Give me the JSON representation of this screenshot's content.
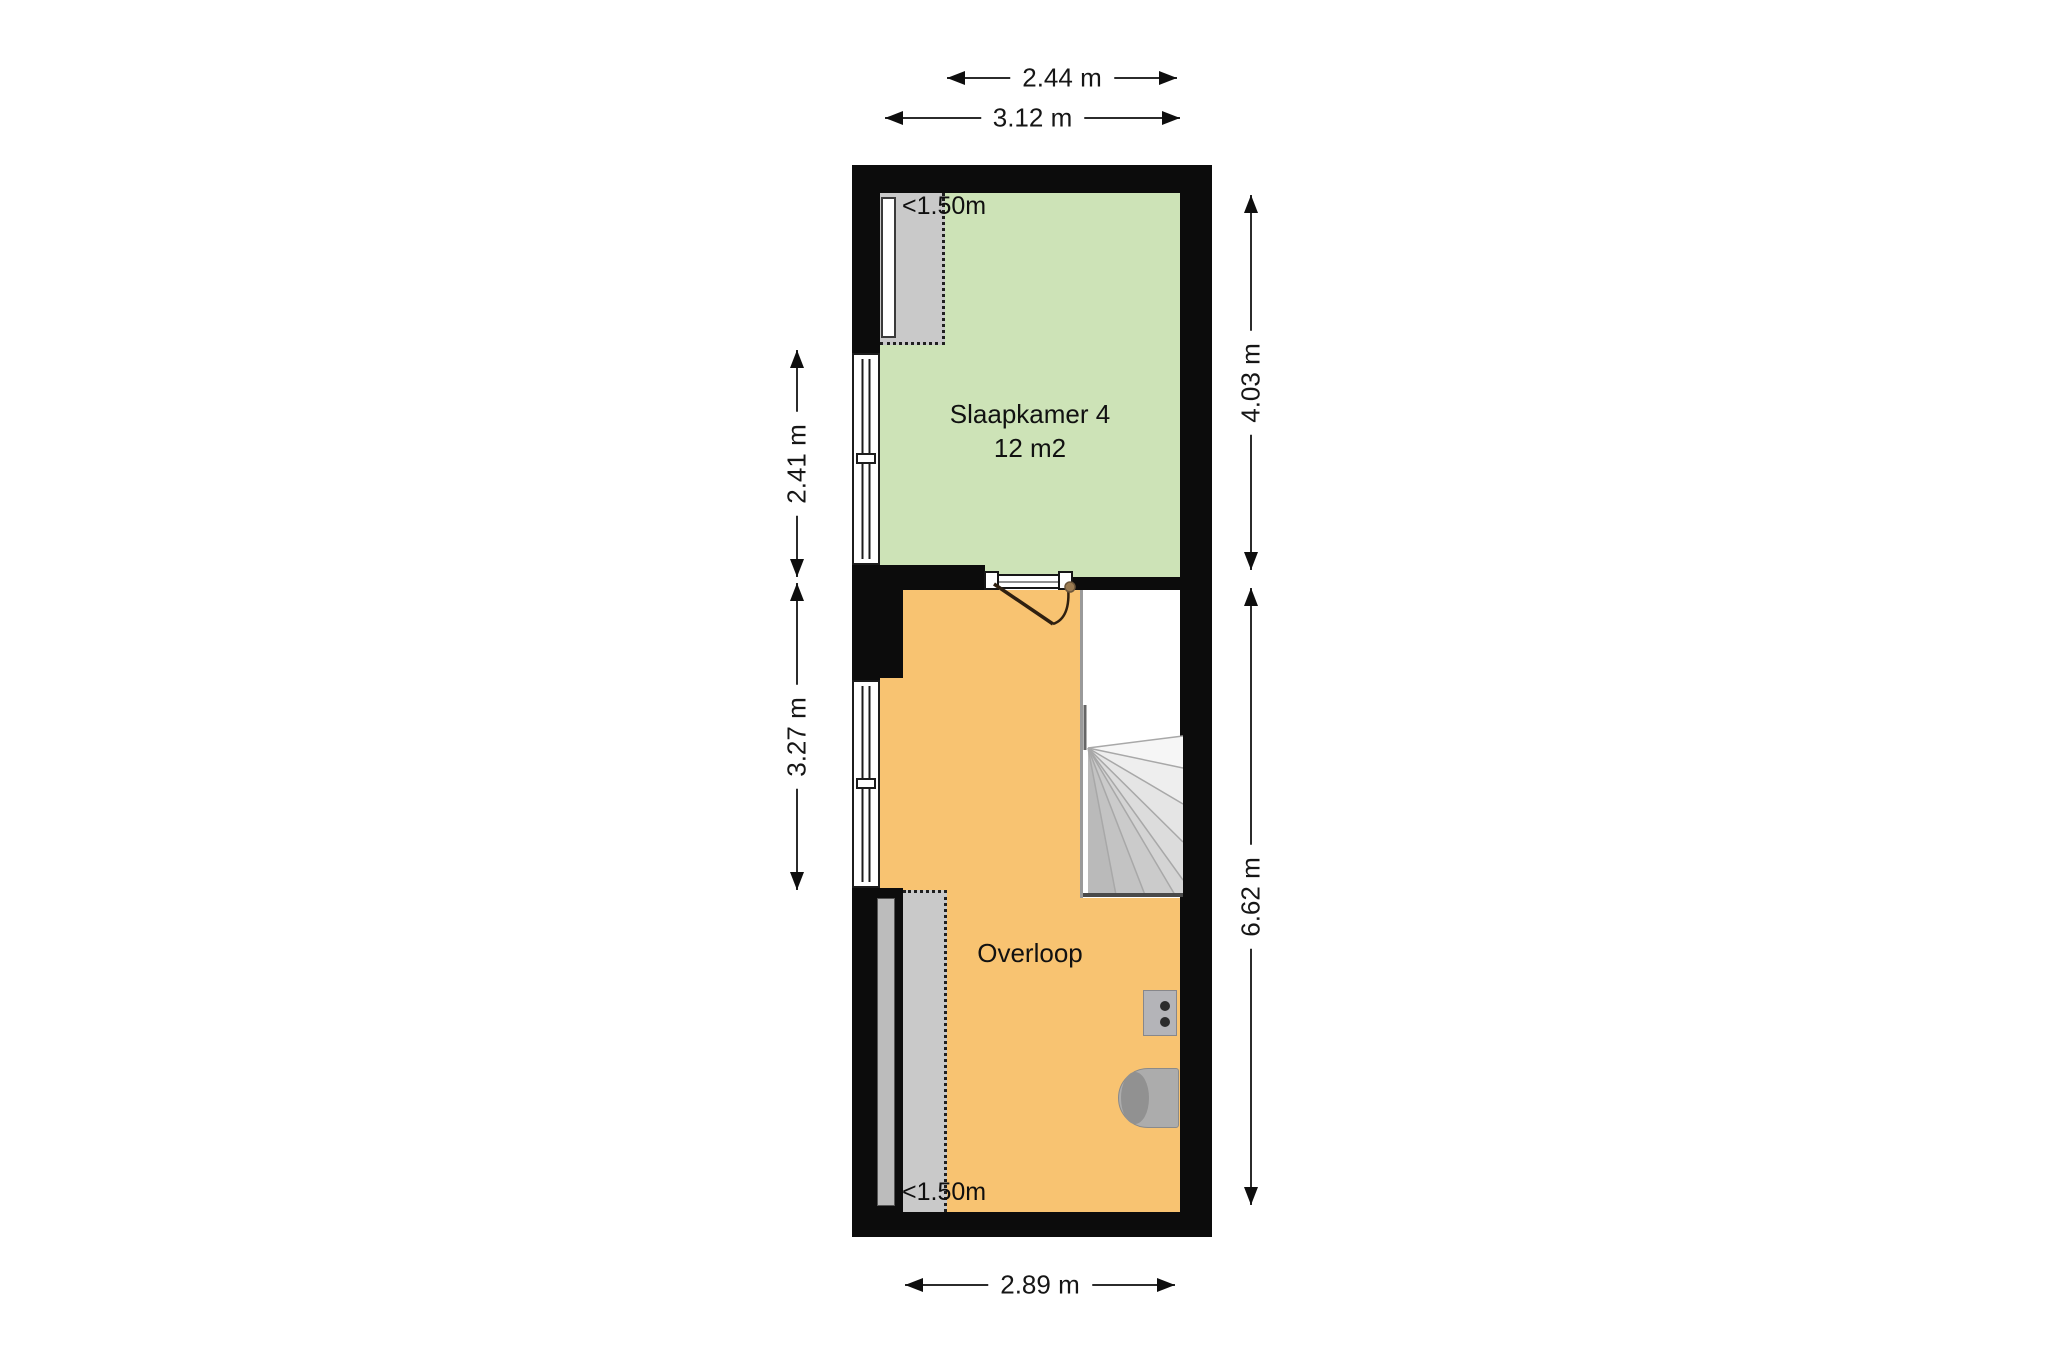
{
  "floorplan": {
    "rooms": [
      {
        "name": "Slaapkamer 4",
        "area": "12 m2"
      },
      {
        "name": "Overloop"
      }
    ],
    "low_headroom": [
      {
        "label": "<1.50m",
        "position": "top-left"
      },
      {
        "label": "<1.50m",
        "position": "bottom-left"
      }
    ],
    "dimensions": {
      "top_inner": {
        "label": "2.44 m"
      },
      "top_outer": {
        "label": "3.12 m"
      },
      "left_upper": {
        "label": "2.41 m"
      },
      "left_lower": {
        "label": "3.27 m"
      },
      "right_upper": {
        "label": "4.03 m"
      },
      "right_lower": {
        "label": "6.62 m"
      },
      "bottom": {
        "label": "2.89 m"
      }
    },
    "features": {
      "stairs": "winder-stairs",
      "door": "door-swing-into-overloop",
      "windows": [
        "left-wall-upper-window",
        "left-wall-lower-window"
      ],
      "appliances": [
        "ventilation-unit",
        "boiler"
      ]
    },
    "colors": {
      "wall": "#0c0c0c",
      "room_green": "#cde3b7",
      "room_orange": "#f8c371",
      "low_headroom_gray": "#c9c9c9"
    }
  }
}
